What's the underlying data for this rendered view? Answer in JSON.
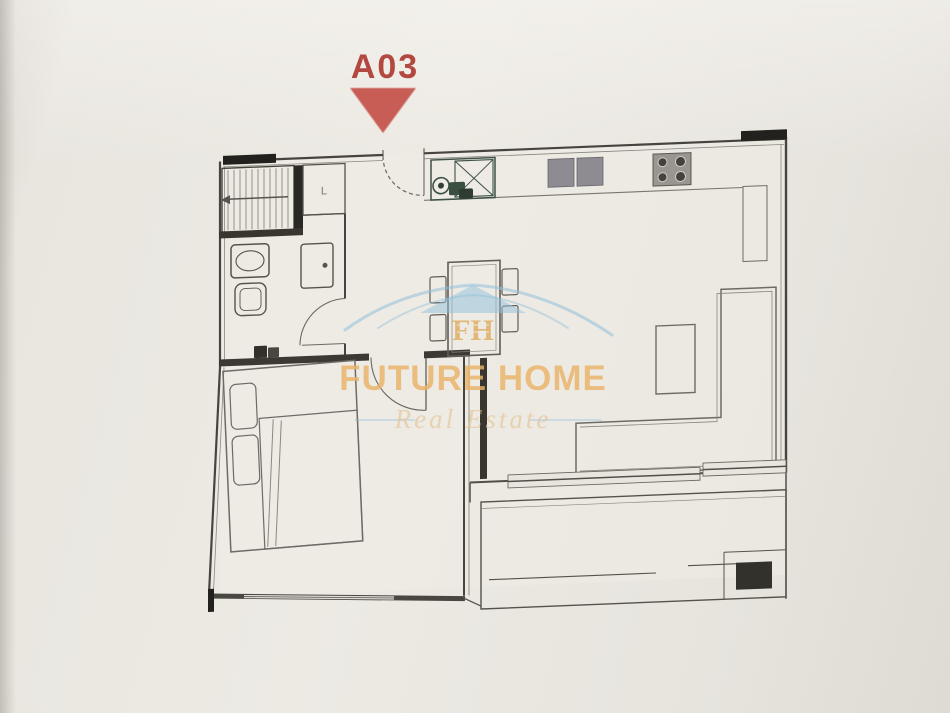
{
  "page": {
    "paper_color": "#e9e6e0"
  },
  "unit": {
    "label": "A03",
    "label_color": "#b2483f",
    "marker_color": "#c5534a"
  },
  "watermark": {
    "brand_line1": "FUTURE HOME",
    "brand_line2": "Real Estate",
    "monogram": "FH",
    "roof_color": "#8fc0da",
    "text_gold": "#eab468",
    "subtext_gold": "#e4c18f"
  },
  "floor_plan": {
    "closet_label": "L",
    "wall_color": "#45423d",
    "furniture_color": "#6e6b65",
    "sink_green": "#3d5244",
    "appliance_gray": "#8e8b93"
  }
}
